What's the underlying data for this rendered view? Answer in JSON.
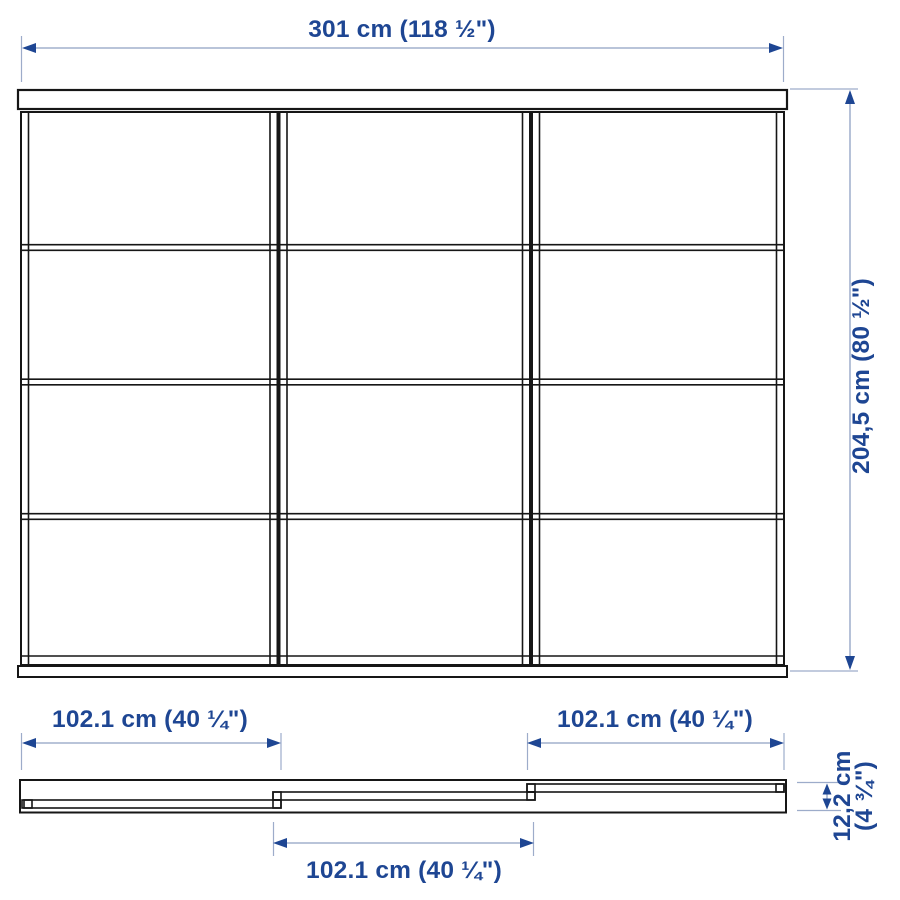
{
  "drawing_title": "sliding-door-combination-dimension-diagram",
  "colors": {
    "line_ink": "#161616",
    "dimension_line": "#8fa0c2",
    "accent_text": "#1e4693",
    "background": "#ffffff"
  },
  "dimensions": {
    "total_width": "301 cm (118 ½\")",
    "total_height": "204,5 cm (80 ½\")",
    "door_left_width": "102.1 cm (40 ¼\")",
    "door_right_width": "102.1 cm (40 ¼\")",
    "door_middle_width": "102.1 cm (40 ¼\")",
    "track_depth_line1": "12,2 cm",
    "track_depth_line2": "(4 ¾\")"
  }
}
